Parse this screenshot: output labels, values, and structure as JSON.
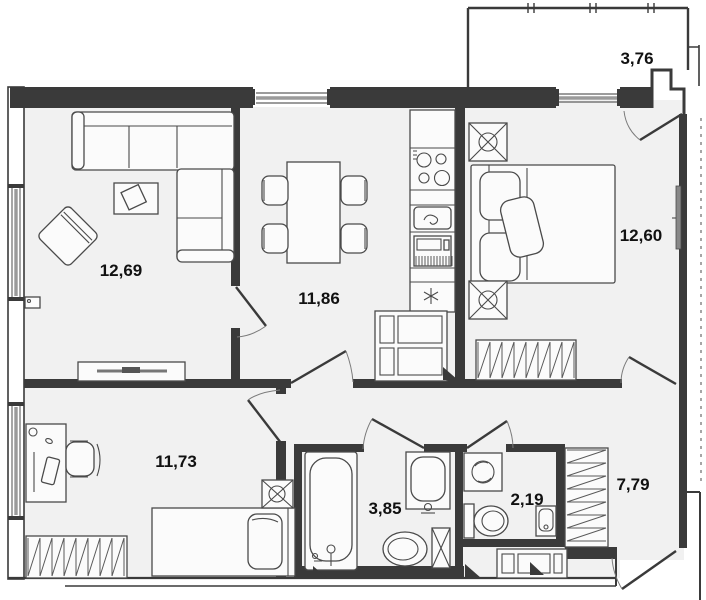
{
  "floor_plan": {
    "rooms": [
      {
        "id": "living-room",
        "area": "12,69"
      },
      {
        "id": "kitchen",
        "area": "11,86"
      },
      {
        "id": "bedroom",
        "area": "12,60"
      },
      {
        "id": "balcony",
        "area": "3,76"
      },
      {
        "id": "bedroom-2",
        "area": "11,73"
      },
      {
        "id": "bathroom",
        "area": "3,85"
      },
      {
        "id": "wc",
        "area": "2,19"
      },
      {
        "id": "hallway",
        "area": "7,79"
      }
    ],
    "colors": {
      "wall": "#3a3a3a",
      "floor": "#f1f1f1",
      "furniture_stroke": "#4a4a4a",
      "window_glass": "#9a9a9a",
      "label": "#111111"
    }
  }
}
